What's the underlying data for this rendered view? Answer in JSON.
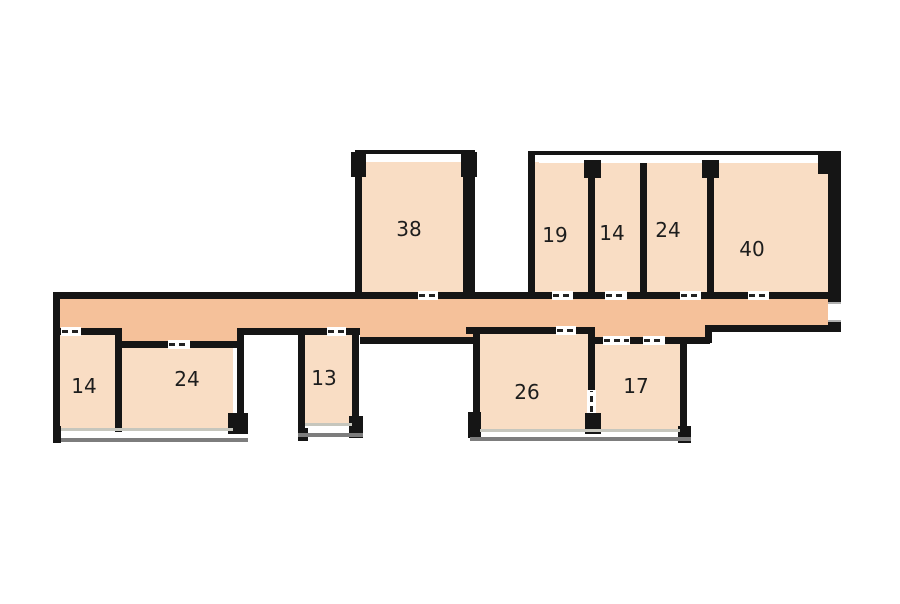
{
  "title": "apartment-floor-plan",
  "colors": {
    "background": "#ffffff",
    "room_fill": "#f9ddc4",
    "corridor_fill": "#f5c19a",
    "wall": "#151515",
    "window_light": "#c6c6bd",
    "window_dark": "#7d7d7d",
    "label_color": "#1d1d1d"
  },
  "rooms": {
    "r38": {
      "label": "38"
    },
    "r19": {
      "label": "19"
    },
    "r14t": {
      "label": "14"
    },
    "r24t": {
      "label": "24"
    },
    "r40": {
      "label": "40"
    },
    "r14b": {
      "label": "14"
    },
    "r24b": {
      "label": "24"
    },
    "r13": {
      "label": "13"
    },
    "r26": {
      "label": "26"
    },
    "r17": {
      "label": "17"
    }
  }
}
